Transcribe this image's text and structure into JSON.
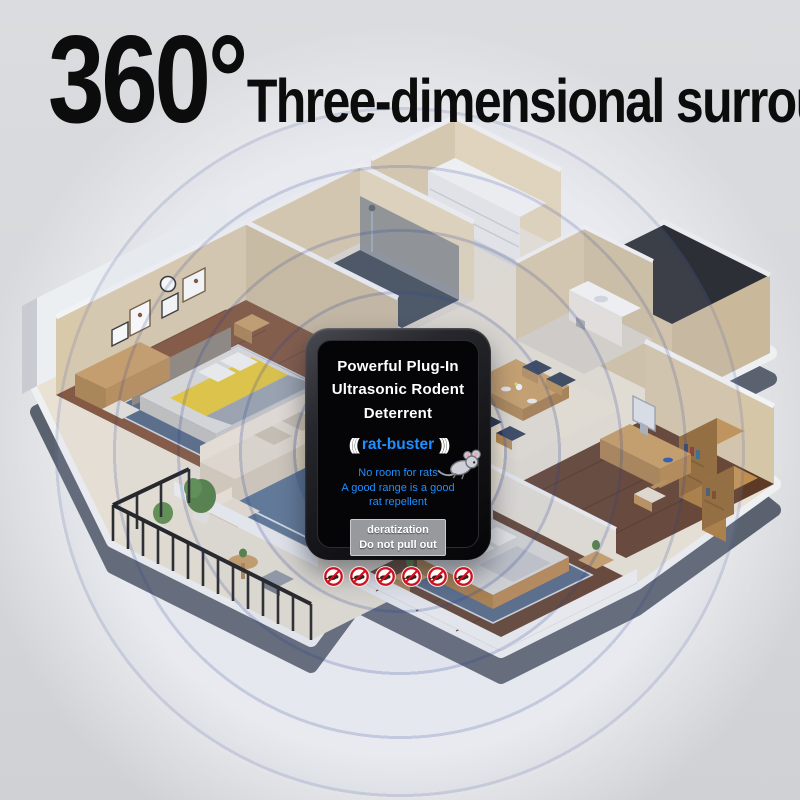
{
  "headline": {
    "degree": "360°",
    "text": "Three-dimensional surround"
  },
  "device": {
    "title_lines": [
      "Powerful Plug-In",
      "Ultrasonic Rodent",
      "Deterrent"
    ],
    "brand": "rat-buster",
    "brand_wave_left": "(((",
    "brand_wave_right": ")))",
    "slogan_lines": [
      "No room for rats",
      "A good range is a good",
      "rat repellent"
    ],
    "label_lines": [
      "deratization",
      "Do not pull out"
    ],
    "badges": {
      "count": 6,
      "icon": "no-rodent-icon"
    },
    "colors": {
      "brand_blue": "#1f8fff",
      "screen_black": "#050507",
      "bezel_dark": "#26262b",
      "label_gray": "#97999c",
      "badge_red": "#cf1020"
    }
  },
  "scene": {
    "type": "isometric cutaway apartment with ultrasonic wave rings",
    "wave_rings": 5,
    "rooms": [
      "master bedroom",
      "shower bathroom",
      "walk-in closet",
      "hallway",
      "dining room",
      "washroom",
      "living room",
      "balcony",
      "second bedroom",
      "study"
    ],
    "colors": {
      "background": "#d7d9dc",
      "wall_beige": "#d6c6a8",
      "wood_floor": "#7d4e33",
      "dark_wood_floor": "#5d3a26",
      "rug_blue": "#56708e",
      "slab_gray": "#5a6270",
      "ring_blue": "#5868a8"
    }
  }
}
